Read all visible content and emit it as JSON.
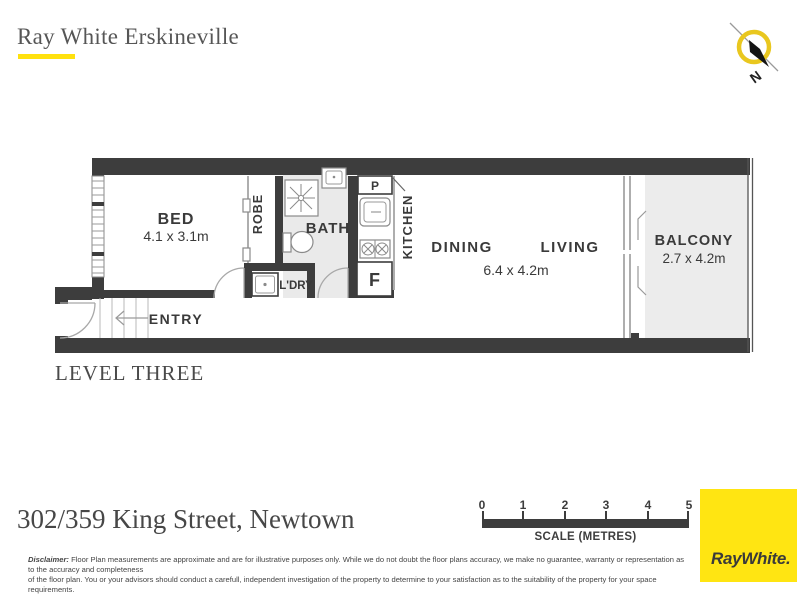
{
  "header": {
    "agency": "Ray White Erskineville"
  },
  "compass": {
    "north_label": "N"
  },
  "plan": {
    "level": "LEVEL THREE",
    "labels": {
      "bed": "BED",
      "bed_dims": "4.1 x 3.1m",
      "robe": "ROBE",
      "bath": "BATH",
      "laundry": "L'DRY",
      "kitchen": "KITCHEN",
      "pantry": "P",
      "fridge": "F",
      "dining": "DINING",
      "living": "LIVING",
      "living_dims": "6.4 x 4.2m",
      "balcony": "BALCONY",
      "balcony_dims": "2.7 x 4.2m",
      "entry": "ENTRY"
    }
  },
  "footer": {
    "address": "302/359 King Street, Newtown",
    "scale": {
      "ticks": [
        "0",
        "1",
        "2",
        "3",
        "4",
        "5"
      ],
      "caption": "SCALE (METRES)"
    },
    "logo_text": "RayWhite.",
    "disclaimer_label": "Disclaimer:",
    "disclaimer_line1": "Floor Plan measurements are approximate and are for illustrative purposes only. While we do not doubt the floor plans accuracy, we make no guarantee, warranty or representation as to the accuracy and completeness",
    "disclaimer_line2": "of the floor plan. You or your advisors should conduct a carefull, independent investigation of the property to determine to your satisfaction as to the suitability of the property for your space requirements."
  },
  "colors": {
    "wall": "#3d3d3d",
    "bath_floor": "#eaeaea",
    "balcony_floor": "#ececec",
    "accent_yellow": "#FFE10E",
    "logo_yellow": "#FFE512",
    "compass_ring": "#E9C71F",
    "text_dark": "#3a3a3a",
    "serif_text": "#4a4a4a"
  }
}
